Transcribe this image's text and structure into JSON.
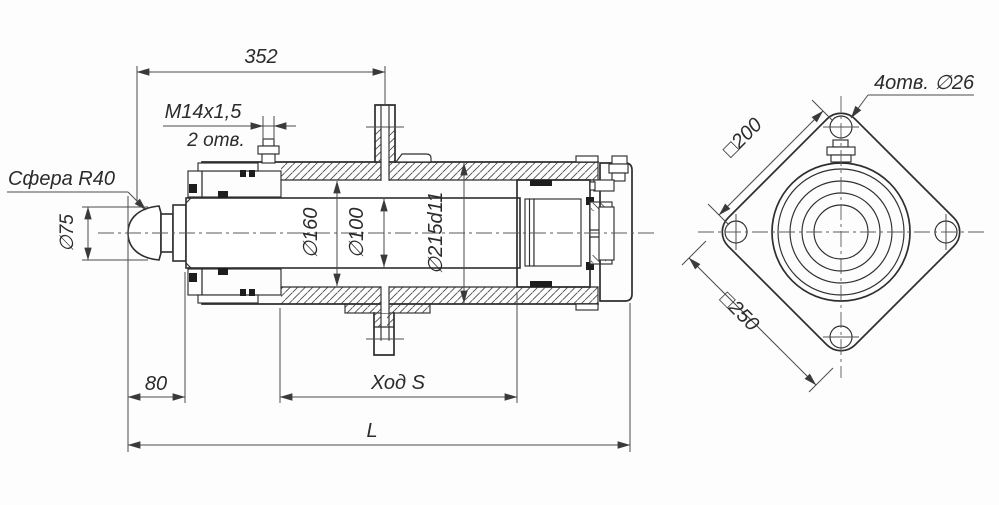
{
  "colors": {
    "line": "#2e2e2e",
    "dim_line": "#4a4a4a",
    "background": "#fdfdfd"
  },
  "side_view": {
    "dim_352": "352",
    "thread_label": "M14x1,5",
    "thread_holes_label": "2 отв.",
    "sphere_label": "Сфера R40",
    "dia_rod_end": "∅75",
    "dia_bore": "∅160",
    "dia_rod": "∅100",
    "dia_outer": "∅215d11",
    "dim_80": "80",
    "stroke_label": "Ход S",
    "length_label": "L"
  },
  "end_view": {
    "holes_label": "4отв. ∅26",
    "square_bolt_circle": "□200",
    "square_flange": "□250"
  }
}
